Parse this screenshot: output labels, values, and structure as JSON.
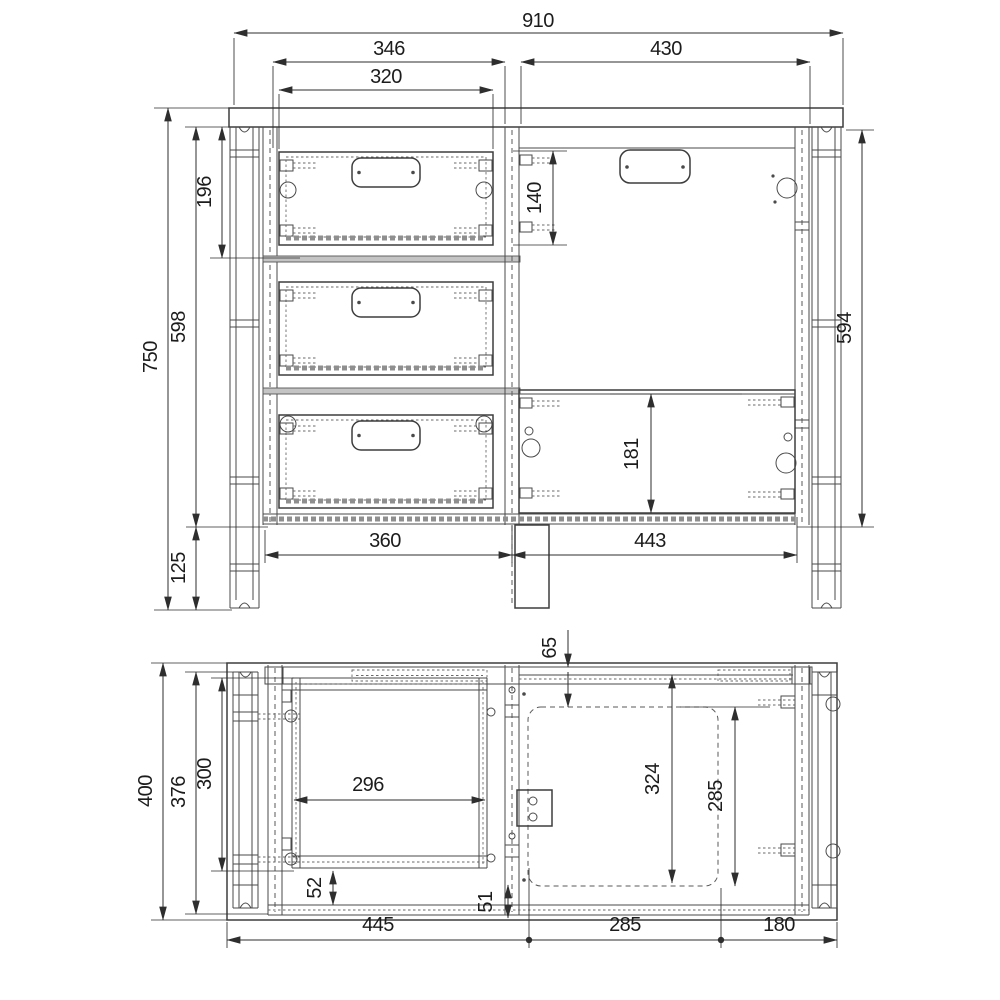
{
  "drawing": {
    "kind": "furniture technical drawing, two orthographic views",
    "background": "#ffffff",
    "line_color": "#4a4a4a",
    "dim_color": "#2e2e2e",
    "text_color": "#1c1c1c"
  },
  "front_dims": {
    "overall_width": "910",
    "drawer_opening_width": "346",
    "drawer_front_width": "320",
    "knee_space_width": "430",
    "top_drawer_height": "196",
    "cutout_drop": "140",
    "overall_height": "750",
    "side_panel_height": "598",
    "right_inner_height": "594",
    "foot_height": "125",
    "left_bottom_width": "360",
    "right_bottom_width": "443",
    "modesty_panel_height": "181"
  },
  "plan_dims": {
    "overall_depth": "400",
    "carcass_depth": "376",
    "drawer_box_depth": "300",
    "drawer_inner_width": "296",
    "front_offset": "65",
    "knee_depth": "324",
    "under_panel_depth": "285",
    "left_back_gap": "52",
    "center_back_gap": "51",
    "bottom_left_width": "445",
    "bottom_middle_width": "285",
    "bottom_right_width": "180"
  }
}
